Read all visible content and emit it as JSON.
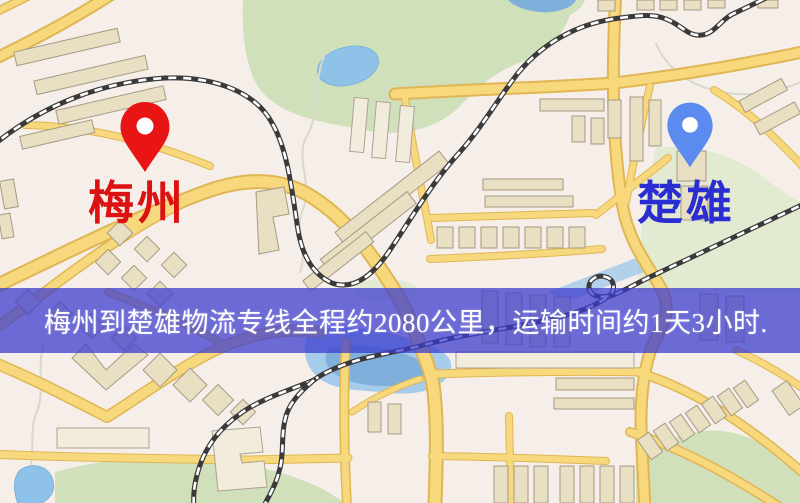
{
  "banner": {
    "text": "梅州到楚雄物流专线全程约2080公里，运输时间约1天3小时.",
    "background_color": "#3c3cce",
    "text_color": "#ffffff"
  },
  "markers": {
    "origin": {
      "label": "梅州",
      "label_color": "#dc1111",
      "pin_color": "#e91414",
      "pin_style": "teardrop"
    },
    "destination": {
      "label": "楚雄",
      "label_color": "#2a2ed2",
      "pin_color": "#5b8bee",
      "pin_style": "teardrop"
    }
  },
  "basemap": {
    "background_color": "#f6efe9",
    "road_color": "#f7d87d",
    "road_casing_color": "#e0b654",
    "water_color": "#8fc2e8",
    "park_color": "#cfe0ba",
    "building_color": "#e9dfc2",
    "railway_color": "#3a3a3a"
  }
}
